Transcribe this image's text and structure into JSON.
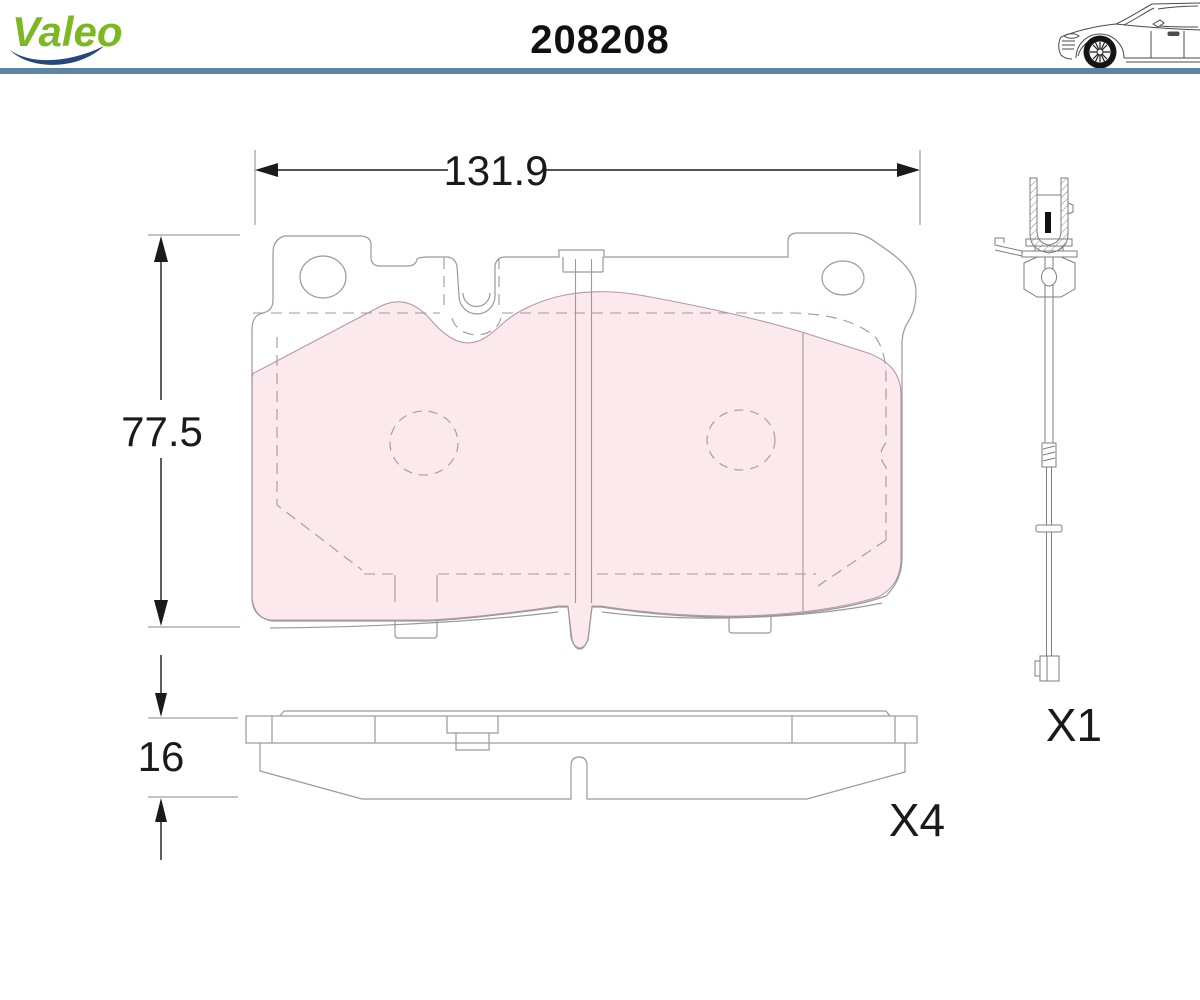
{
  "header": {
    "brand": "Valeo",
    "part_number": "208208"
  },
  "drawing": {
    "dimensions": {
      "width": "131.9",
      "height": "77.5",
      "thickness": "16"
    },
    "quantities": {
      "pad_quantity": "X4",
      "sensor_quantity": "X1"
    },
    "icons": {
      "logo": "valeo-logo",
      "vehicle": "car-side-illustration",
      "sensor": "wear-indicator-sensor"
    },
    "colors": {
      "accent_blue": "#5b84a7",
      "brand_green": "#7cb822",
      "swoosh_blue": "#26477d",
      "friction_fill": "#fbe9ed",
      "friction_line": "#a8949b",
      "outline_gray": "#9a9a9a",
      "dimension_black": "#1a1a1a"
    }
  }
}
